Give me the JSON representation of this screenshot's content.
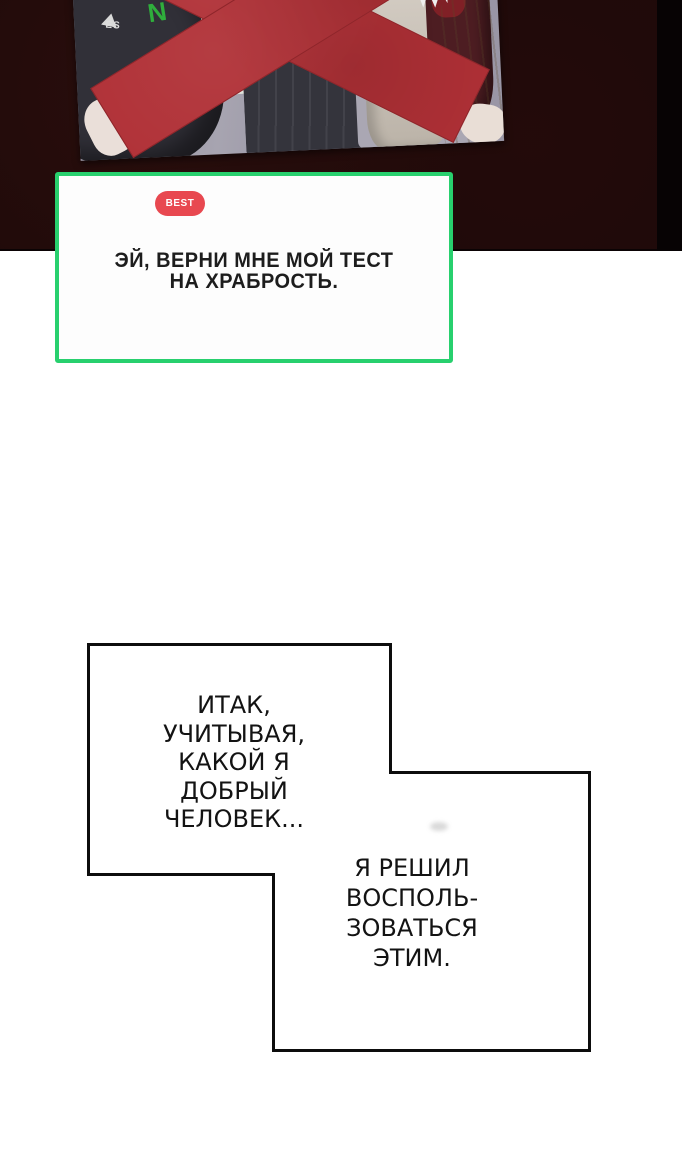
{
  "page": {
    "background_color": "#ffffff",
    "top_band_color": "#1d0909"
  },
  "photo_panel": {
    "x_mark_color": "#b03036",
    "jacket_letter": "N",
    "jacket_text": "ES"
  },
  "best_comment": {
    "badge_label": "BEST",
    "badge_color": "#e84850",
    "border_color": "#28d06e",
    "lines": [
      "ЭЙ, ВЕРНИ МНЕ МОЙ ТЕСТ",
      "НА ХРАБРОСТЬ."
    ]
  },
  "speech_bubbles": [
    {
      "lines": [
        "ИТАК,",
        "УЧИТЫВАЯ,",
        "КАКОЙ Я",
        "ДОБРЫЙ",
        "ЧЕЛОВЕК..."
      ]
    },
    {
      "lines": [
        "Я РЕШИЛ",
        "ВОСПОЛЬ-",
        "ЗОВАТЬСЯ",
        "ЭТИМ."
      ]
    }
  ]
}
